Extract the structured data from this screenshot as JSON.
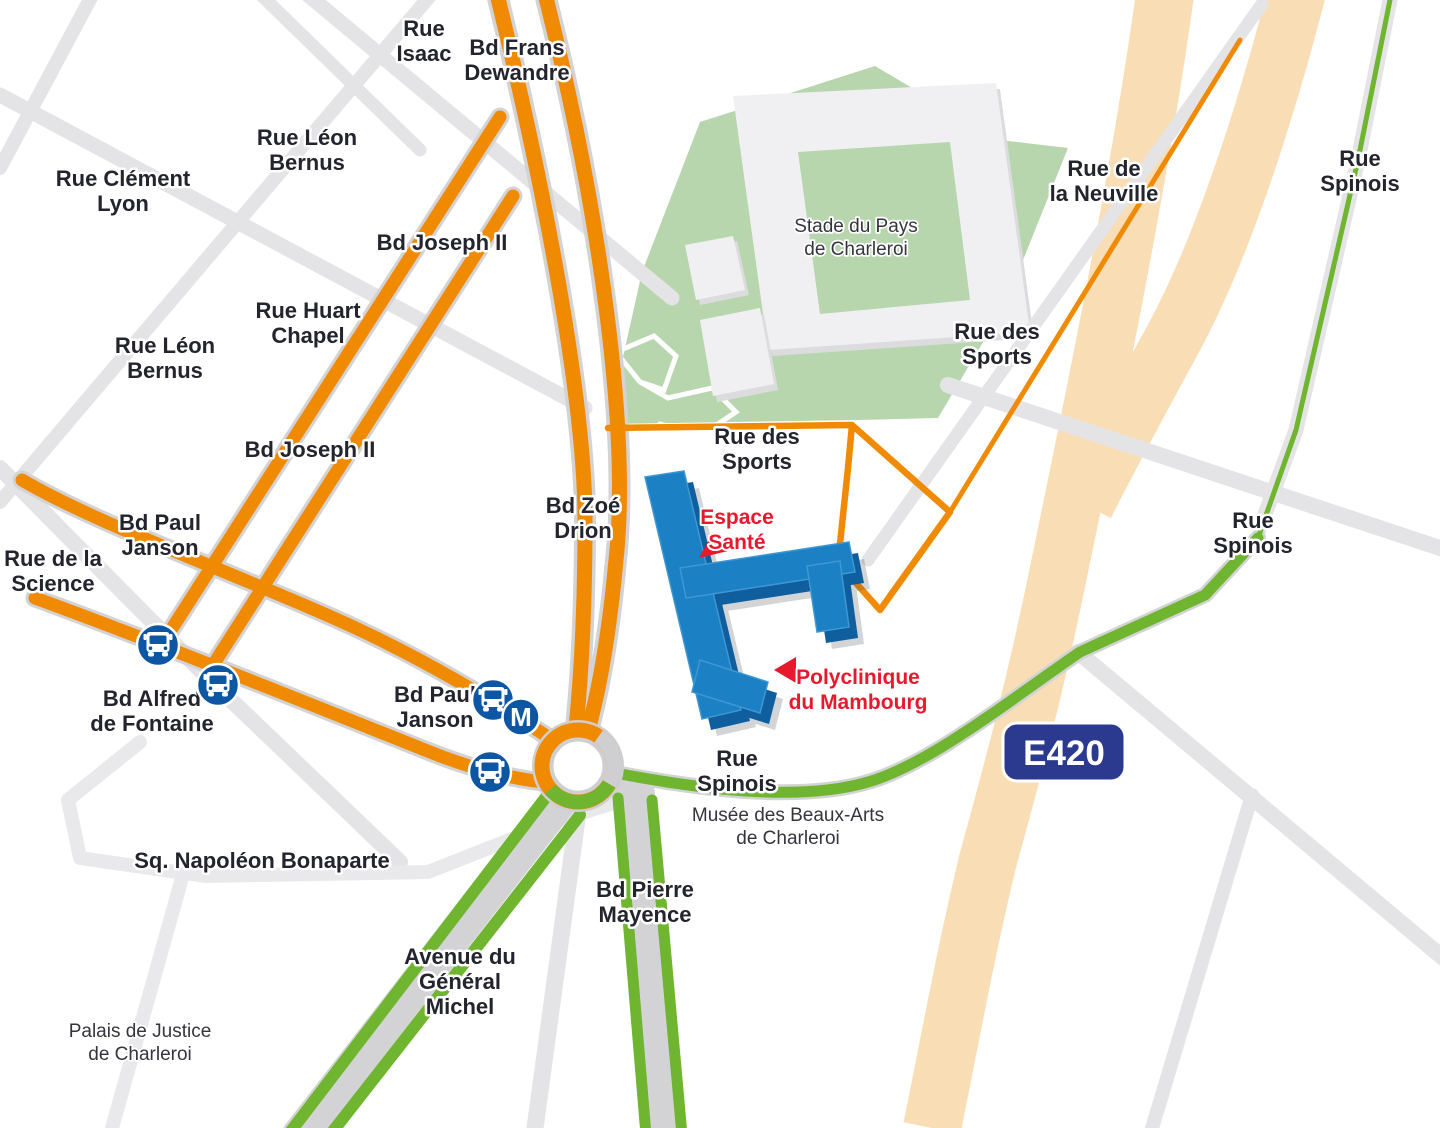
{
  "map_type": "access-map",
  "colors": {
    "orange_road": "#F08A00",
    "green_road": "#6FB52F",
    "highway_beige": "#F9DDB4",
    "park_green": "#B7D6AE",
    "building_blue": "#1B80C4",
    "building_blue_dark": "#0F5F9E",
    "label_dark": "#23242E",
    "accent_red": "#E8192C",
    "transit_blue": "#0D56A4",
    "badge_blue": "#2B3A8F",
    "road_gray": "#E4E4E6"
  },
  "highway_badge": {
    "label": "E420"
  },
  "metro": {
    "label": "M"
  },
  "icons": {
    "bus": "bus-icon",
    "metro": "metro-icon"
  },
  "street_labels": [
    {
      "lines": [
        "Rue",
        "Isaac"
      ]
    },
    {
      "lines": [
        "Bd Frans",
        "Dewandre"
      ]
    },
    {
      "lines": [
        "Rue Léon",
        "Bernus"
      ]
    },
    {
      "lines": [
        "Rue Clément",
        "Lyon"
      ]
    },
    {
      "lines": [
        "Bd Joseph II"
      ]
    },
    {
      "lines": [
        "Rue Huart",
        "Chapel"
      ]
    },
    {
      "lines": [
        "Rue Léon",
        "Bernus"
      ]
    },
    {
      "lines": [
        "Bd Joseph II"
      ]
    },
    {
      "lines": [
        "Bd Paul",
        "Janson"
      ]
    },
    {
      "lines": [
        "Rue de la",
        "Science"
      ]
    },
    {
      "lines": [
        "Bd Zoé",
        "Drion"
      ]
    },
    {
      "lines": [
        "Rue des",
        "Sports"
      ]
    },
    {
      "lines": [
        "Rue de",
        "la Neuville"
      ]
    },
    {
      "lines": [
        "Rue des",
        "Sports"
      ]
    },
    {
      "lines": [
        "Rue",
        "Spinois"
      ]
    },
    {
      "lines": [
        "Rue",
        "Spinois"
      ]
    },
    {
      "lines": [
        "Bd Paul",
        "Janson"
      ]
    },
    {
      "lines": [
        "Bd Alfred",
        "de Fontaine"
      ]
    },
    {
      "lines": [
        "Rue",
        "Spinois"
      ]
    },
    {
      "lines": [
        "Bd Pierre",
        "Mayence"
      ]
    },
    {
      "lines": [
        "Avenue du",
        "Général",
        "Michel"
      ]
    },
    {
      "lines": [
        "Sq. Napoléon Bonaparte"
      ]
    }
  ],
  "places": {
    "stadium": {
      "lines": [
        "Stade du Pays",
        "de Charleroi"
      ]
    },
    "museum": {
      "lines": [
        "Musée des Beaux-Arts",
        "de Charleroi"
      ]
    },
    "courthouse": {
      "lines": [
        "Palais de Justice",
        "de Charleroi"
      ]
    }
  },
  "destinations": {
    "espace_sante": {
      "lines": [
        "Espace",
        "Santé"
      ]
    },
    "polyclinique": {
      "lines": [
        "Polyclinique",
        "du Mambourg"
      ]
    }
  }
}
